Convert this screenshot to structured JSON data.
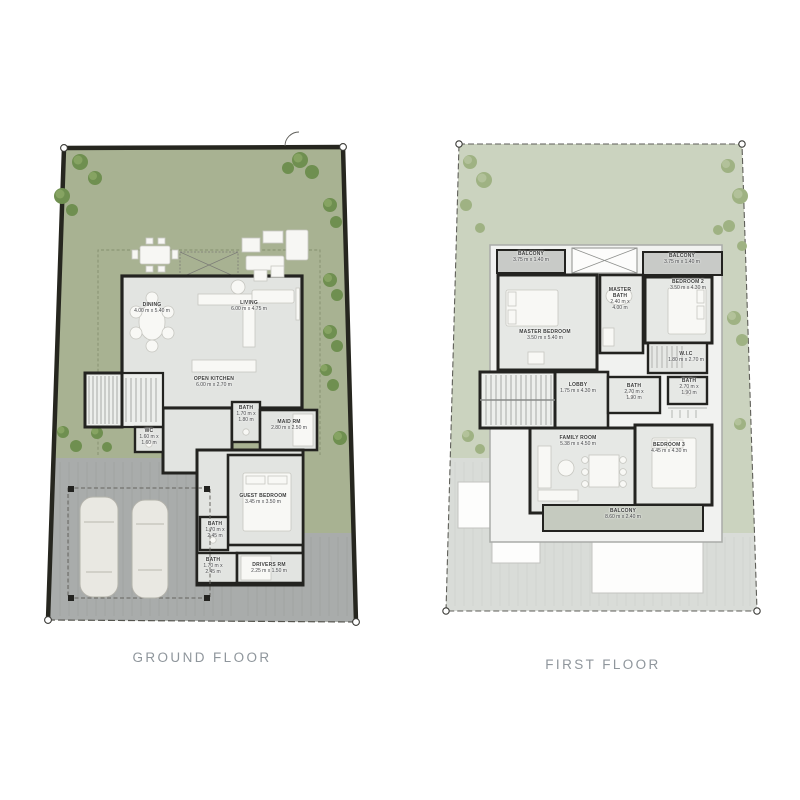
{
  "page": {
    "background": "#ffffff"
  },
  "floors": {
    "ground": {
      "label": "GROUND FLOOR",
      "rooms": {
        "dining": {
          "name": "DINING",
          "dims": "4.00 m x 5.40 m"
        },
        "living": {
          "name": "LIVING",
          "dims": "6.00 m x 4.75 m"
        },
        "kitchen": {
          "name": "OPEN KITCHEN",
          "dims": "6.00 m x 2.70 m"
        },
        "wc": {
          "name": "WC",
          "dims": "1.60 m x 1.60 m"
        },
        "bath1": {
          "name": "BATH",
          "dims": "1.70 m x 1.80 m"
        },
        "maid": {
          "name": "MAID RM",
          "dims": "2.80 m x 2.50 m"
        },
        "guest": {
          "name": "GUEST BEDROOM",
          "dims": "3.45 m x 3.50 m"
        },
        "bath2": {
          "name": "BATH",
          "dims": "1.70 m x 2.45 m"
        },
        "bath3": {
          "name": "BATH",
          "dims": "1.70 m x 2.45 m"
        },
        "drivers": {
          "name": "DRIVERS RM",
          "dims": "2.25 m x 1.50 m"
        }
      }
    },
    "first": {
      "label": "FIRST FLOOR",
      "rooms": {
        "balcony_left": {
          "name": "BALCONY",
          "dims": "3.75 m x 1.40 m"
        },
        "balcony_right": {
          "name": "BALCONY",
          "dims": "3.75 m x 1.40 m"
        },
        "master_bedroom": {
          "name": "MASTER BEDROOM",
          "dims": "3.50 m x 5.40 m"
        },
        "master_bath": {
          "name": "MASTER BATH",
          "dims": "2.40 m x 4.00 m"
        },
        "bedroom2": {
          "name": "BEDROOM 2",
          "dims": "3.50 m x 4.30 m"
        },
        "wic": {
          "name": "W.I.C",
          "dims": "1.80 m x 2.70 m"
        },
        "lobby": {
          "name": "LOBBY",
          "dims": "1.75 m x 4.30 m"
        },
        "bath_center": {
          "name": "BATH",
          "dims": "2.70 m x 1.90 m"
        },
        "bath_right": {
          "name": "BATH",
          "dims": "2.70 m x 1.90 m"
        },
        "family_room": {
          "name": "FAMILY ROOM",
          "dims": "5.38 m x 4.50 m"
        },
        "bedroom3": {
          "name": "BEDROOM 3",
          "dims": "4.45 m x 4.30 m"
        },
        "balcony_bottom": {
          "name": "BALCONY",
          "dims": "8.60 m x 2.40 m"
        }
      }
    }
  },
  "colors": {
    "garden_ground": "#a8b292",
    "garden_first": "#cbd3bf",
    "paving_ground": "#a9acab",
    "paving_first": "#d9dcd8",
    "wall": "#232320",
    "house_fill_ground": "#e2e4e1",
    "house_fill_first": "#e6e8e5",
    "balcony_fill": "#c8cac7",
    "tree_ground": "#6f8f50",
    "tree_first": "#9fb283",
    "title_text": "#8f969c",
    "room_label_text": "#3a3b3a"
  }
}
